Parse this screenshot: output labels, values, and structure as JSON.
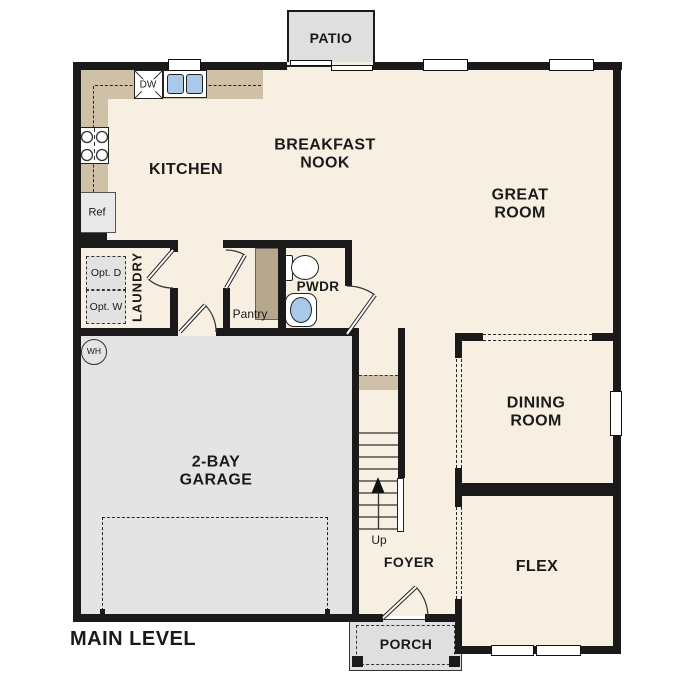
{
  "plan": {
    "title": "MAIN LEVEL",
    "rooms": {
      "patio": "PATIO",
      "kitchen": "KITCHEN",
      "breakfast_nook": "BREAKFAST NOOK",
      "great_room": "GREAT ROOM",
      "laundry": "LAUNDRY",
      "pwdr": "PWDR",
      "pantry": "Pantry",
      "dining_room": "DINING ROOM",
      "garage": "2-BAY GARAGE",
      "flex": "FLEX",
      "foyer": "FOYER",
      "porch": "PORCH"
    },
    "fixtures": {
      "dishwasher": "DW",
      "refrigerator": "Ref",
      "optional_dryer": "Opt. D",
      "optional_washer": "Opt. W",
      "water_heater": "WH",
      "stairs_up": "Up"
    },
    "colors": {
      "floor": "#f7efe2",
      "counter": "#cfc1a8",
      "shelf": "#b7a78d",
      "garage_floor": "#e4e4e4",
      "outdoor": "#dfdfdf",
      "wall": "#1a1a1a",
      "sink_blue": "#a9c9e9"
    }
  }
}
